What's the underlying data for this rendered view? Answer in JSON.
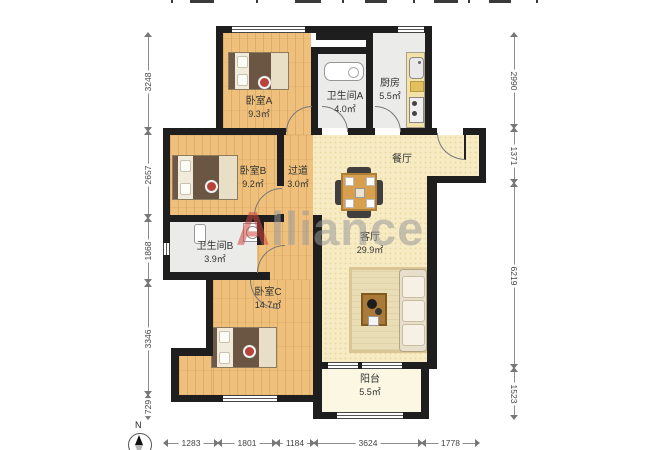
{
  "watermark": {
    "first": "A",
    "rest": "lliance"
  },
  "compass": {
    "north": "N"
  },
  "rooms": {
    "bedroomA": {
      "name": "卧室A",
      "area": "9.3㎡"
    },
    "bathroomA": {
      "name": "卫生间A",
      "area": "4.0㎡"
    },
    "kitchen": {
      "name": "厨房",
      "area": "5.5㎡"
    },
    "bedroomB": {
      "name": "卧室B",
      "area": "9.2㎡"
    },
    "hallway": {
      "name": "过道",
      "area": "3.0㎡"
    },
    "dining": {
      "name": "餐厅"
    },
    "bathroomB": {
      "name": "卫生间B",
      "area": "3.9㎡"
    },
    "bedroomC": {
      "name": "卧室C",
      "area": "14.7㎡"
    },
    "living": {
      "name": "客厅",
      "area": "29.9㎡"
    },
    "balcony": {
      "name": "阳台",
      "area": "5.5㎡"
    }
  },
  "dimensions": {
    "left": [
      "3248",
      "2657",
      "1868",
      "3346",
      "729"
    ],
    "right": [
      "2990",
      "1371",
      "6219",
      "1523"
    ],
    "bottom": [
      "1283",
      "1801",
      "1184",
      "3624",
      "1778"
    ],
    "top_note": "labels clipped at top edge of image (illegible)"
  },
  "colors": {
    "wall": "#1e1e1e",
    "wood_floor": "#eec07c",
    "tile_floor": "#ebebe9",
    "living_floor": "#f7ebc3",
    "balcony_floor": "#fbf7e2",
    "counter": "#f3e3a8",
    "table": "#d79f4e",
    "watermark_red": "#cf4740",
    "watermark_gray": "#9b9b9b",
    "dimension_text": "#444444"
  }
}
